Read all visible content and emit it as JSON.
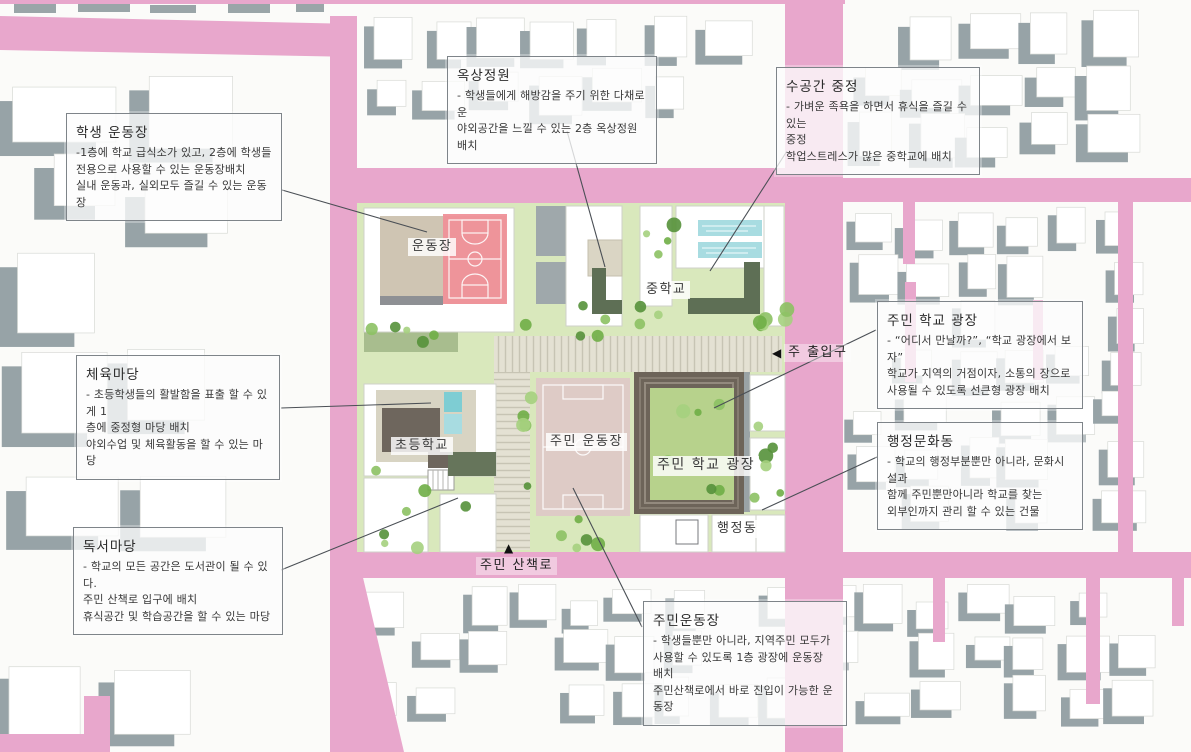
{
  "plan_labels": {
    "playground": "운동장",
    "middle_school": "중학교",
    "elementary_school": "초등학교",
    "resident_field": "주민 운동장",
    "resident_school_plaza": "주민 학교 광장",
    "admin_building": "행정동",
    "main_entrance": "주 출입구",
    "main_entrance_marker": "◀",
    "resident_walk": "주민 산책로",
    "resident_walk_marker": "▲"
  },
  "annotations": [
    {
      "title": "학생 운동장",
      "body": "-1층에 학교 급식소가 있고, 2층에 학생들\n전용으로 사용할 수 있는 운동장배치\n실내 운동과, 실외모두 즐길 수 있는 운동장"
    },
    {
      "title": "옥상정원",
      "body": "- 학생들에게 해방감을 주기 위한 다채로운\n야외공간을 느낄 수 있는 2층 옥상정원 배치"
    },
    {
      "title": "수공간 중정",
      "body": "- 가벼운 족욕을 하면서 휴식을 즐길 수 있는\n중정\n학업스트레스가 많은 중학교에 배치"
    },
    {
      "title": "주민 학교 광장",
      "body": "- “어디서 만날까?”, “학교 광장에서 보자”\n학교가 지역의 거점이자, 소통의 장으로\n사용될 수 있도록 선큰형 광장 배치"
    },
    {
      "title": "행정문화동",
      "body": "- 학교의 행정부분뿐만 아니라, 문화시설과\n함께 주민뿐만아니라 학교를 찾는\n외부인까지 관리 할 수 있는 건물"
    },
    {
      "title": "체육마당",
      "body": "- 초등학생들의 활발함을 표출 할 수 있게 1\n층에 중정형 마당 배치\n야외수업 및 체육활동을 할 수 있는 마당"
    },
    {
      "title": "독서마당",
      "body": "- 학교의 모든 공간은 도서관이 될 수 있다.\n주민 산책로 입구에 배치\n휴식공간 및 학습공간을 할 수 있는 마당"
    },
    {
      "title": "주민운동장",
      "body": "- 학생들뿐만 아니라, 지역주민 모두가\n사용할 수 있도록 1층 광장에 운동장 배치\n주민산책로에서 바로 진입이 가능한 운동장"
    }
  ],
  "colors": {
    "road_pink": "#e8a7cc",
    "building_shadow_gray": "#97a3a7",
    "site_green": "#d9e8bc",
    "terrace_green": "#a8bd8e",
    "dark_building_green": "#5e6f55",
    "court_red": "#ef9199",
    "court_apron_tan": "#cfc5b3",
    "soccer_field_tan": "#decbc6",
    "sunken_plaza_brown": "#6d6459",
    "plaza_lawn_green": "#b7d28c",
    "pool_blue": "#a8dce1",
    "walkway_beige": "#e4e1d3"
  }
}
